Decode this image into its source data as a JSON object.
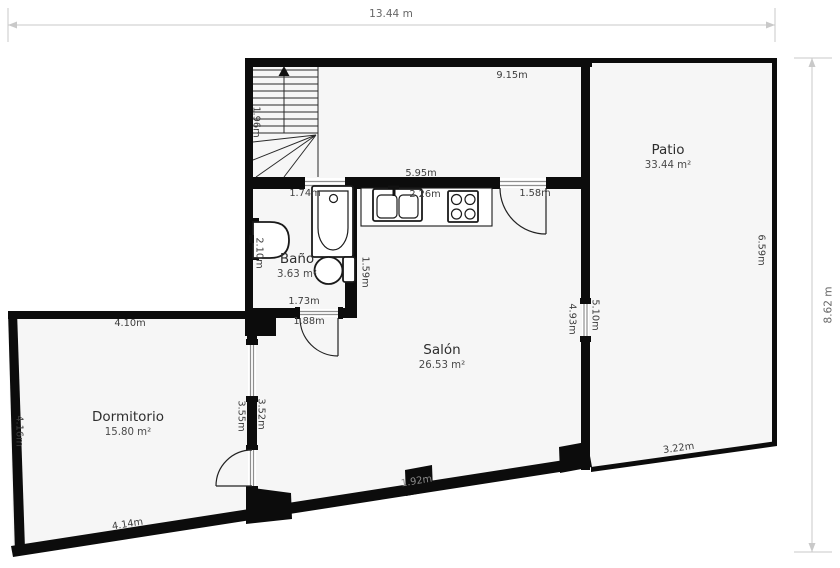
{
  "plan": {
    "overall_width": "13.44 m",
    "overall_height": "8.62 m"
  },
  "rooms": {
    "patio": {
      "name": "Patio",
      "area": "33.44 m²"
    },
    "bano": {
      "name": "Baño",
      "area": "3.63 m²"
    },
    "salon": {
      "name": "Salón",
      "area": "26.53 m²"
    },
    "dormitorio": {
      "name": "Dormitorio",
      "area": "15.80 m²"
    }
  },
  "measurements": {
    "top_span": "9.15m",
    "stairs_width": "1.96m",
    "bath_tub_wall": "1.74m",
    "kitchen_wall": "5.95m",
    "kitchen_counter": "2.26m",
    "salon_door": "1.58m",
    "basin_wall": "2.10m",
    "bath_width": "1.73m",
    "bath_door": "1.88m",
    "toilet_wall": "1.59m",
    "salon_window_inner": "4.93m",
    "salon_window_outer": "5.10m",
    "patio_right": "6.59m",
    "patio_bottom": "3.22m",
    "salon_bottom": "1.92m",
    "dorm_top": "4.10m",
    "dorm_left": "4.16m",
    "dorm_bottom": "4.14m",
    "dorm_window_left": "3.55m",
    "dorm_window_right": "3.52m"
  },
  "colors": {
    "wall": "#0c0c0c",
    "room_fill": "#f6f6f6",
    "dimension_line": "#c9c9c9",
    "dimension_text": "#666666",
    "label_text": "#3d3d3d",
    "window_line": "#8f8f8f"
  }
}
